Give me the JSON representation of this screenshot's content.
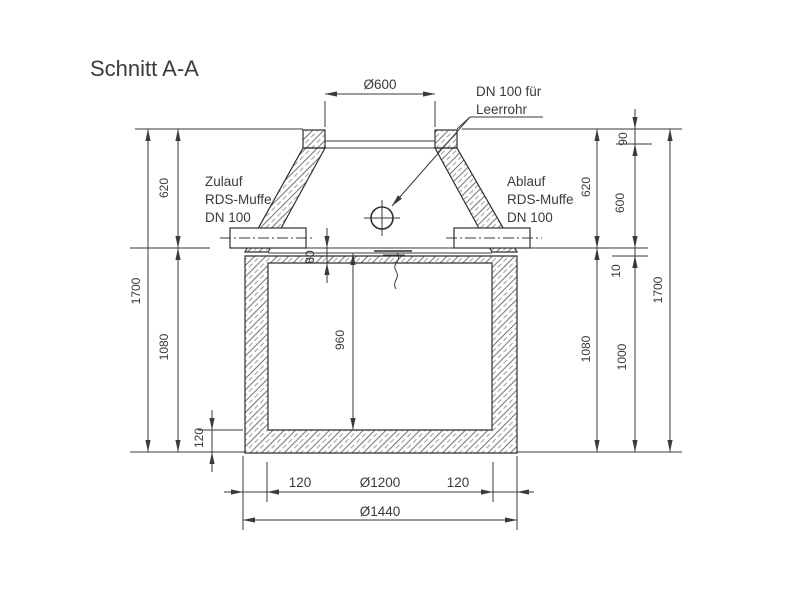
{
  "title": "Schnitt A-A",
  "annotations": {
    "leerrohr": {
      "line1": "DN 100 für",
      "line2": "Leerrohr"
    },
    "zulauf": {
      "line1": "Zulauf",
      "line2": "RDS-Muffe",
      "line3": "DN 100"
    },
    "ablauf": {
      "line1": "Ablauf",
      "line2": "RDS-Muffe",
      "line3": "DN 100"
    }
  },
  "dimensions": {
    "top_opening": "Ø600",
    "left": {
      "total": "1700",
      "upper": "620",
      "lower": "1080",
      "base_slab": "120"
    },
    "inner": {
      "cover": "80",
      "height": "960"
    },
    "right": {
      "upper": "620",
      "ring": "90",
      "cone": "600",
      "joint": "10",
      "lower": "1080",
      "base": "1000",
      "total": "1700"
    },
    "bottom": {
      "wall_left": "120",
      "inner_dia": "Ø1200",
      "wall_right": "120",
      "outer_dia": "Ø1440"
    }
  },
  "colors": {
    "line": "#3a3a3a",
    "text": "#3a3a3a",
    "background": "#ffffff"
  }
}
